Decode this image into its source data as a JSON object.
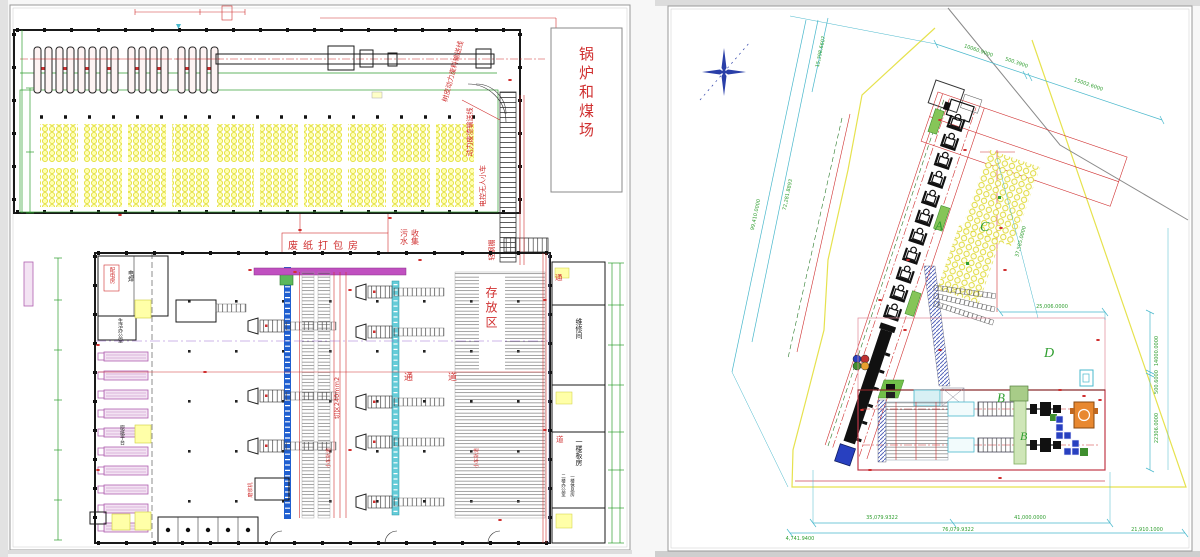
{
  "left": {
    "boiler_coal_yard": "锅炉和煤场",
    "waste_paper_packing": "废纸打包房",
    "sewage_col1": "污水",
    "sewage_col2": "收集",
    "storage_area": "存放区",
    "cut_area": "切区240mm2",
    "corridor_a": "通",
    "corridor_b": "道",
    "distribution_room": "配电房",
    "welding": "电焊",
    "office": "生活办公室",
    "paper_platform": "原纸平台",
    "bark_conveyor": "树皮动力废料输送线",
    "slag_conveyor": "动力废渣输送线",
    "unmanned_cart": "电控无人小车",
    "steel_shed": "轻钢棚",
    "repair_room": "维修间",
    "bunk_room": "一楼板房",
    "office_2f": "二楼办公室",
    "rest_room_1f": "一楼休息房",
    "refiner": "磨浆机",
    "cart_track": "小车轨道"
  },
  "right": {
    "area_a": "A",
    "area_b": "B",
    "area_b2": "B",
    "area_c": "C",
    "area_d": "D",
    "dim_top_1": "10060.9000",
    "dim_top_2": "500.3900",
    "dim_top_3": "15002.6000",
    "dim_left_1": "15,398.6607",
    "dim_left_2": "72,281.8893",
    "dim_left_3": "99,410.0000",
    "dim_c": "37,585.0000",
    "dim_right_1": "14000.0000",
    "dim_right_2": "500.6000",
    "dim_right_3": "22306.0000",
    "dim_d": "25,006.0000",
    "dim_bottom_1": "35,079.9322",
    "dim_bottom_2": "41,000.0000",
    "dim_bottom_3": "76,079.9322",
    "dim_bottom_4": "4,741.9400",
    "dim_bottom_5": "21,910.1000"
  },
  "colors": {
    "red": "#d03030",
    "green": "#2f9e2f",
    "cyan": "#49b8cc",
    "yellow": "#f0ec50",
    "blue": "#2244bb",
    "magenta": "#c050c0",
    "wall": "#1a1a1a"
  }
}
